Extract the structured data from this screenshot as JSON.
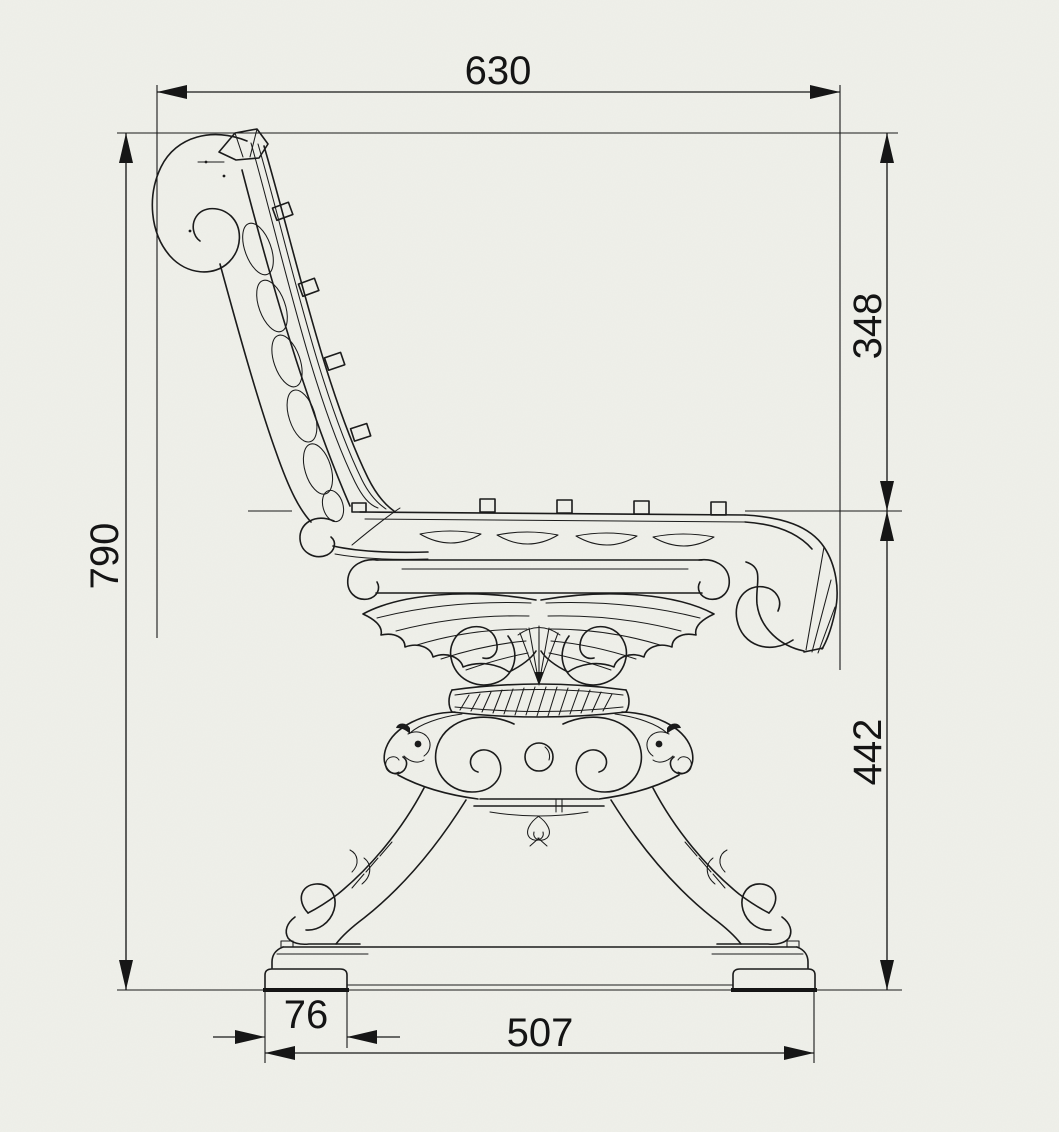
{
  "canvas": {
    "paper_color": "#eff0ea",
    "ink_color": "#1b1b1b"
  },
  "illustration": {
    "name": "cast-iron-bench-side-elevation"
  },
  "dimensions": {
    "top_width": {
      "value": "630",
      "orientation": "horizontal",
      "position": "top"
    },
    "overall_height": {
      "value": "790",
      "orientation": "vertical",
      "position": "left"
    },
    "backrest_height": {
      "value": "348",
      "orientation": "vertical",
      "position": "right-upper"
    },
    "seat_height": {
      "value": "442",
      "orientation": "vertical",
      "position": "right-lower"
    },
    "foot_width": {
      "value": "76",
      "orientation": "horizontal",
      "position": "bottom-left"
    },
    "base_width": {
      "value": "507",
      "orientation": "horizontal",
      "position": "bottom"
    }
  }
}
